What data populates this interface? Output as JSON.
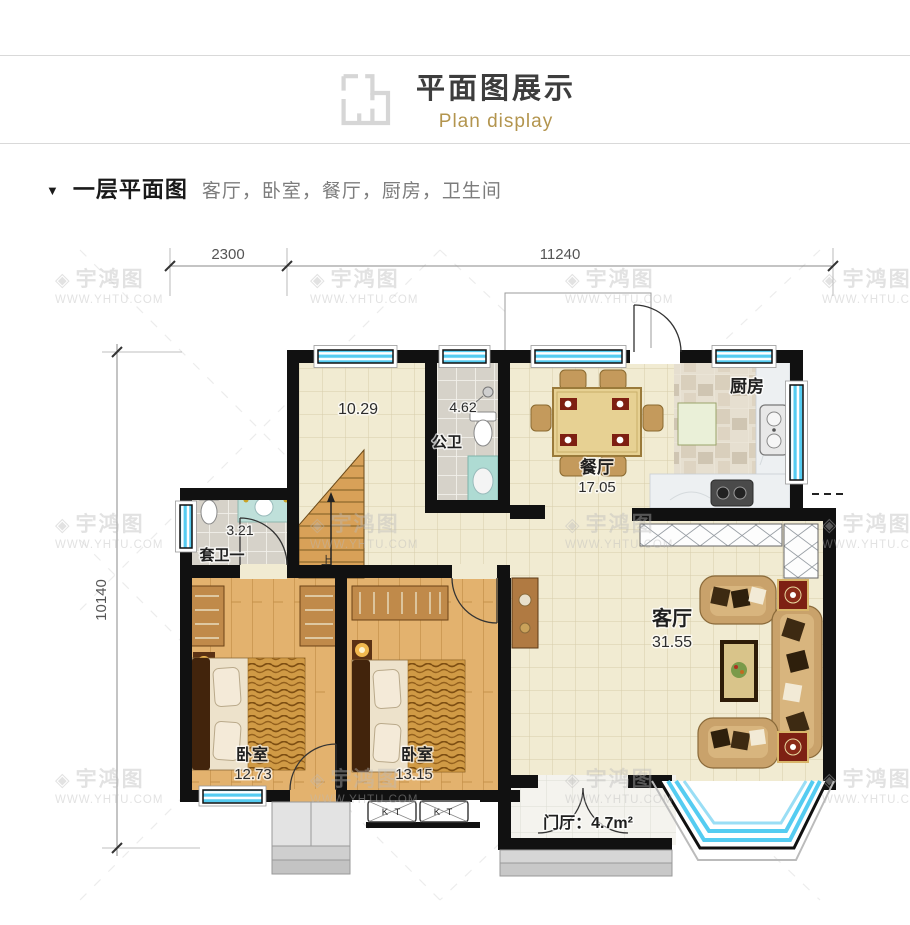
{
  "header": {
    "title": "平面图展示",
    "subtitle": "Plan display"
  },
  "section": {
    "marker": "▼",
    "title": "一层平面图",
    "rooms_list": "客厅，卧室，餐厅，厨房，卫生间"
  },
  "watermark": {
    "icon": "◈",
    "brand": "宇鸿图",
    "url": "WWW.YHTU.COM"
  },
  "plan": {
    "dimensions": {
      "top_left": "2300",
      "top_right": "11240",
      "left": "10140"
    },
    "rooms": {
      "hall": {
        "area": "10.29"
      },
      "public_bath": {
        "name": "公卫",
        "area": "4.62"
      },
      "dining": {
        "name": "餐厅",
        "area": "17.05"
      },
      "kitchen": {
        "name": "厨房"
      },
      "suite_bath": {
        "name": "套卫一",
        "area": "3.21"
      },
      "living": {
        "name": "客厅",
        "area": "31.55"
      },
      "bedroom1": {
        "name": "卧室",
        "area": "12.73"
      },
      "bedroom2": {
        "name": "卧室",
        "area": "13.15"
      },
      "entry": {
        "label": "门厅：4.7m²"
      }
    },
    "stairs": {
      "up": "上"
    },
    "ac_label": "K T"
  },
  "colors": {
    "accent_gold": "#b3954e",
    "wall": "#111111",
    "window_cyan": "#55ccf1",
    "floor_cream": "#f1ebd2",
    "wood": "#e3b26e",
    "title_dark": "#3d3d3d",
    "text_gray": "#7c7c7c"
  }
}
